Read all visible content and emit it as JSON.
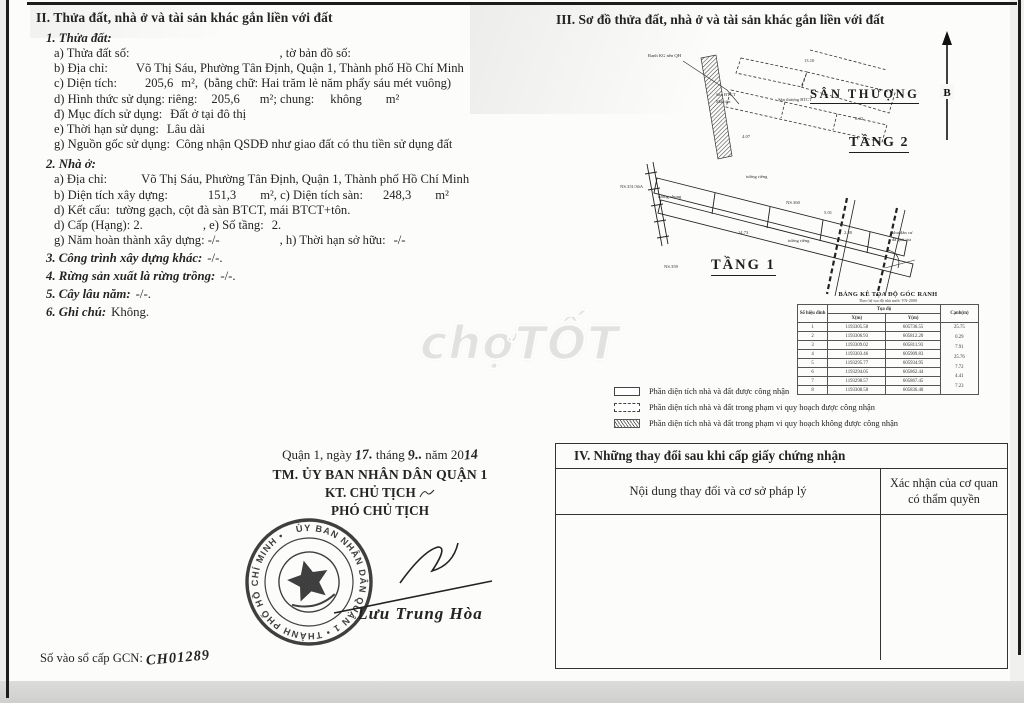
{
  "watermark": {
    "text": "chợTỐT"
  },
  "section2": {
    "title": "II. Thửa đất, nhà ở và tài sản khác gắn liền với đất",
    "land": {
      "heading": "1. Thửa đất:",
      "parcel_no": {
        "label": "a) Thửa đất số:",
        "tail": ", tờ bản đồ số:"
      },
      "address": {
        "label": "b) Địa chỉ:",
        "value": "Võ Thị Sáu, Phường Tân Định, Quận 1, Thành phố Hồ Chí Minh"
      },
      "area": {
        "label": "c) Diện tích:",
        "value": "205,6",
        "unit": "m²,",
        "words": "(bằng chữ: Hai trăm lẻ năm phẩy sáu mét vuông)"
      },
      "use_form": {
        "label": "d) Hình thức sử dụng: riêng:",
        "value": "205,6",
        "mid": "m²; chung:",
        "value2": "không",
        "unit2": "m²"
      },
      "purpose": {
        "label": "đ) Mục đích sử dụng:",
        "value": "Đất ở tại đô thị"
      },
      "term": {
        "label": "e) Thời hạn sử dụng:",
        "value": "Lâu dài"
      },
      "origin": {
        "label": "g) Nguồn gốc sử dụng:",
        "value": "Công nhận QSDĐ như giao đất có thu tiền sử dụng đất"
      }
    },
    "house": {
      "heading": "2. Nhà ở:",
      "address": {
        "label": "a) Địa chỉ:",
        "value": "Võ Thị Sáu, Phường Tân Định, Quận 1, Thành phố Hồ Chí Minh"
      },
      "build_area": {
        "label": "b) Diện tích xây dựng:",
        "value": "151,3",
        "mid": "m², c) Diện tích sàn:",
        "value2": "248,3",
        "unit2": "m²"
      },
      "structure": {
        "label": "d) Kết cấu:",
        "value": "tường gạch, cột đà sàn BTCT, mái BTCT+tôn."
      },
      "grade": {
        "label": "d) Cấp (Hạng): 2.",
        "mid": ", e) Số tầng:",
        "value2": "2."
      },
      "year": {
        "label": "g) Năm hoàn thành xây dựng: -/-",
        "mid": ", h) Thời hạn sở hữu:",
        "value2": "-/-"
      }
    },
    "other_works": {
      "label": "3. Công trình xây dựng khác:",
      "value": "-/-."
    },
    "forest": {
      "label": "4. Rừng sản xuất là rừng trồng:",
      "value": "-/-."
    },
    "perennial": {
      "label": "5. Cây lâu năm:",
      "value": "-/-."
    },
    "note": {
      "label": "6. Ghi chú:",
      "value": "Không."
    }
  },
  "section3": {
    "title": "III. Sơ đồ thửa đất, nhà ở và tài sản khác gắn liền với đất",
    "north_label": "B",
    "labels": {
      "terrace": "SÂN THƯỢNG",
      "floor2": "TẦNG 2",
      "floor1": "TẦNG 1"
    },
    "annotations": [
      {
        "text": "Ranh KG nền QH"
      },
      {
        "text": "Sàn BTCT"
      },
      {
        "text": "Mái tôn"
      },
      {
        "text": "Sân thượng BTCT"
      },
      {
        "text": "13.10"
      },
      {
        "text": "8.42"
      },
      {
        "text": "4.07"
      },
      {
        "text": "tường riêng"
      },
      {
        "text": "tường chung"
      },
      {
        "text": "NS.360"
      },
      {
        "text": "14.73"
      },
      {
        "text": "tường riêng"
      },
      {
        "text": "NS.351/36A"
      },
      {
        "text": "NS.359"
      },
      {
        "text": "5.01"
      },
      {
        "text": "2.20"
      },
      {
        "text": "khu dân cư"
      },
      {
        "text": "đã giải tỏa"
      }
    ],
    "coord_table": {
      "title": "BẢNG KÊ TỌA ĐỘ GÓC RANH",
      "subtitle": "Theo hệ tọa độ nhà nước VN-2000",
      "col_vertex": "Số hiệu đỉnh",
      "col_coord": "Tọa độ",
      "col_x": "X(m)",
      "col_y": "Y(m)",
      "col_edge": "Cạnh(m)",
      "rows": [
        {
          "id": "1",
          "x": "1193305.58",
          "y": "605736.55"
        },
        {
          "id": "2",
          "x": "1193306.93",
          "y": "605812.20"
        },
        {
          "id": "3",
          "x": "1193309.02",
          "y": "605811.93"
        },
        {
          "id": "4",
          "x": "1193303.46",
          "y": "605909.83"
        },
        {
          "id": "5",
          "x": "1193295.77",
          "y": "605934.95"
        },
        {
          "id": "6",
          "x": "1193294.05",
          "y": "605862.44"
        },
        {
          "id": "7",
          "x": "1193298.57",
          "y": "605867.45"
        },
        {
          "id": "8",
          "x": "1193308.58",
          "y": "605836.40"
        }
      ],
      "edges": [
        "25.75",
        "0.29",
        "7.91",
        "25.76",
        "7.72",
        "4.41",
        "7.23"
      ]
    },
    "legend": [
      {
        "text": "Phần diện tích nhà và đất được công nhận"
      },
      {
        "text": "Phần diện tích nhà và đất trong phạm vi quy hoạch được công nhận"
      },
      {
        "text": "Phần diện tích nhà và đất trong phạm vi quy hoạch không được công nhận"
      }
    ]
  },
  "section4": {
    "title": "IV. Những thay đổi sau khi cấp giấy chứng nhận",
    "col_content": "Nội dung thay đổi và cơ sở pháp lý",
    "col_confirm": "Xác nhận của cơ quan có thẩm quyền"
  },
  "signature": {
    "place_line": {
      "p1": "Quận 1, ngày",
      "day": "17.",
      "p2": "tháng",
      "month": "9..",
      "p3": "năm 20",
      "year": "14"
    },
    "authority": "TM. ỦY BAN NHÂN DÂN QUẬN 1",
    "title_kt": "KT. CHỦ TỊCH",
    "title_pho": "PHÓ CHỦ TỊCH",
    "signer": "Lưu Trung Hòa",
    "stamp": "ỦY BAN NHÂN DÂN QUẬN 1 • THÀNH PHỐ HỒ CHÍ MINH •"
  },
  "registry_line": {
    "label": "Số vào sổ cấp GCN:",
    "value": "CH01289"
  }
}
